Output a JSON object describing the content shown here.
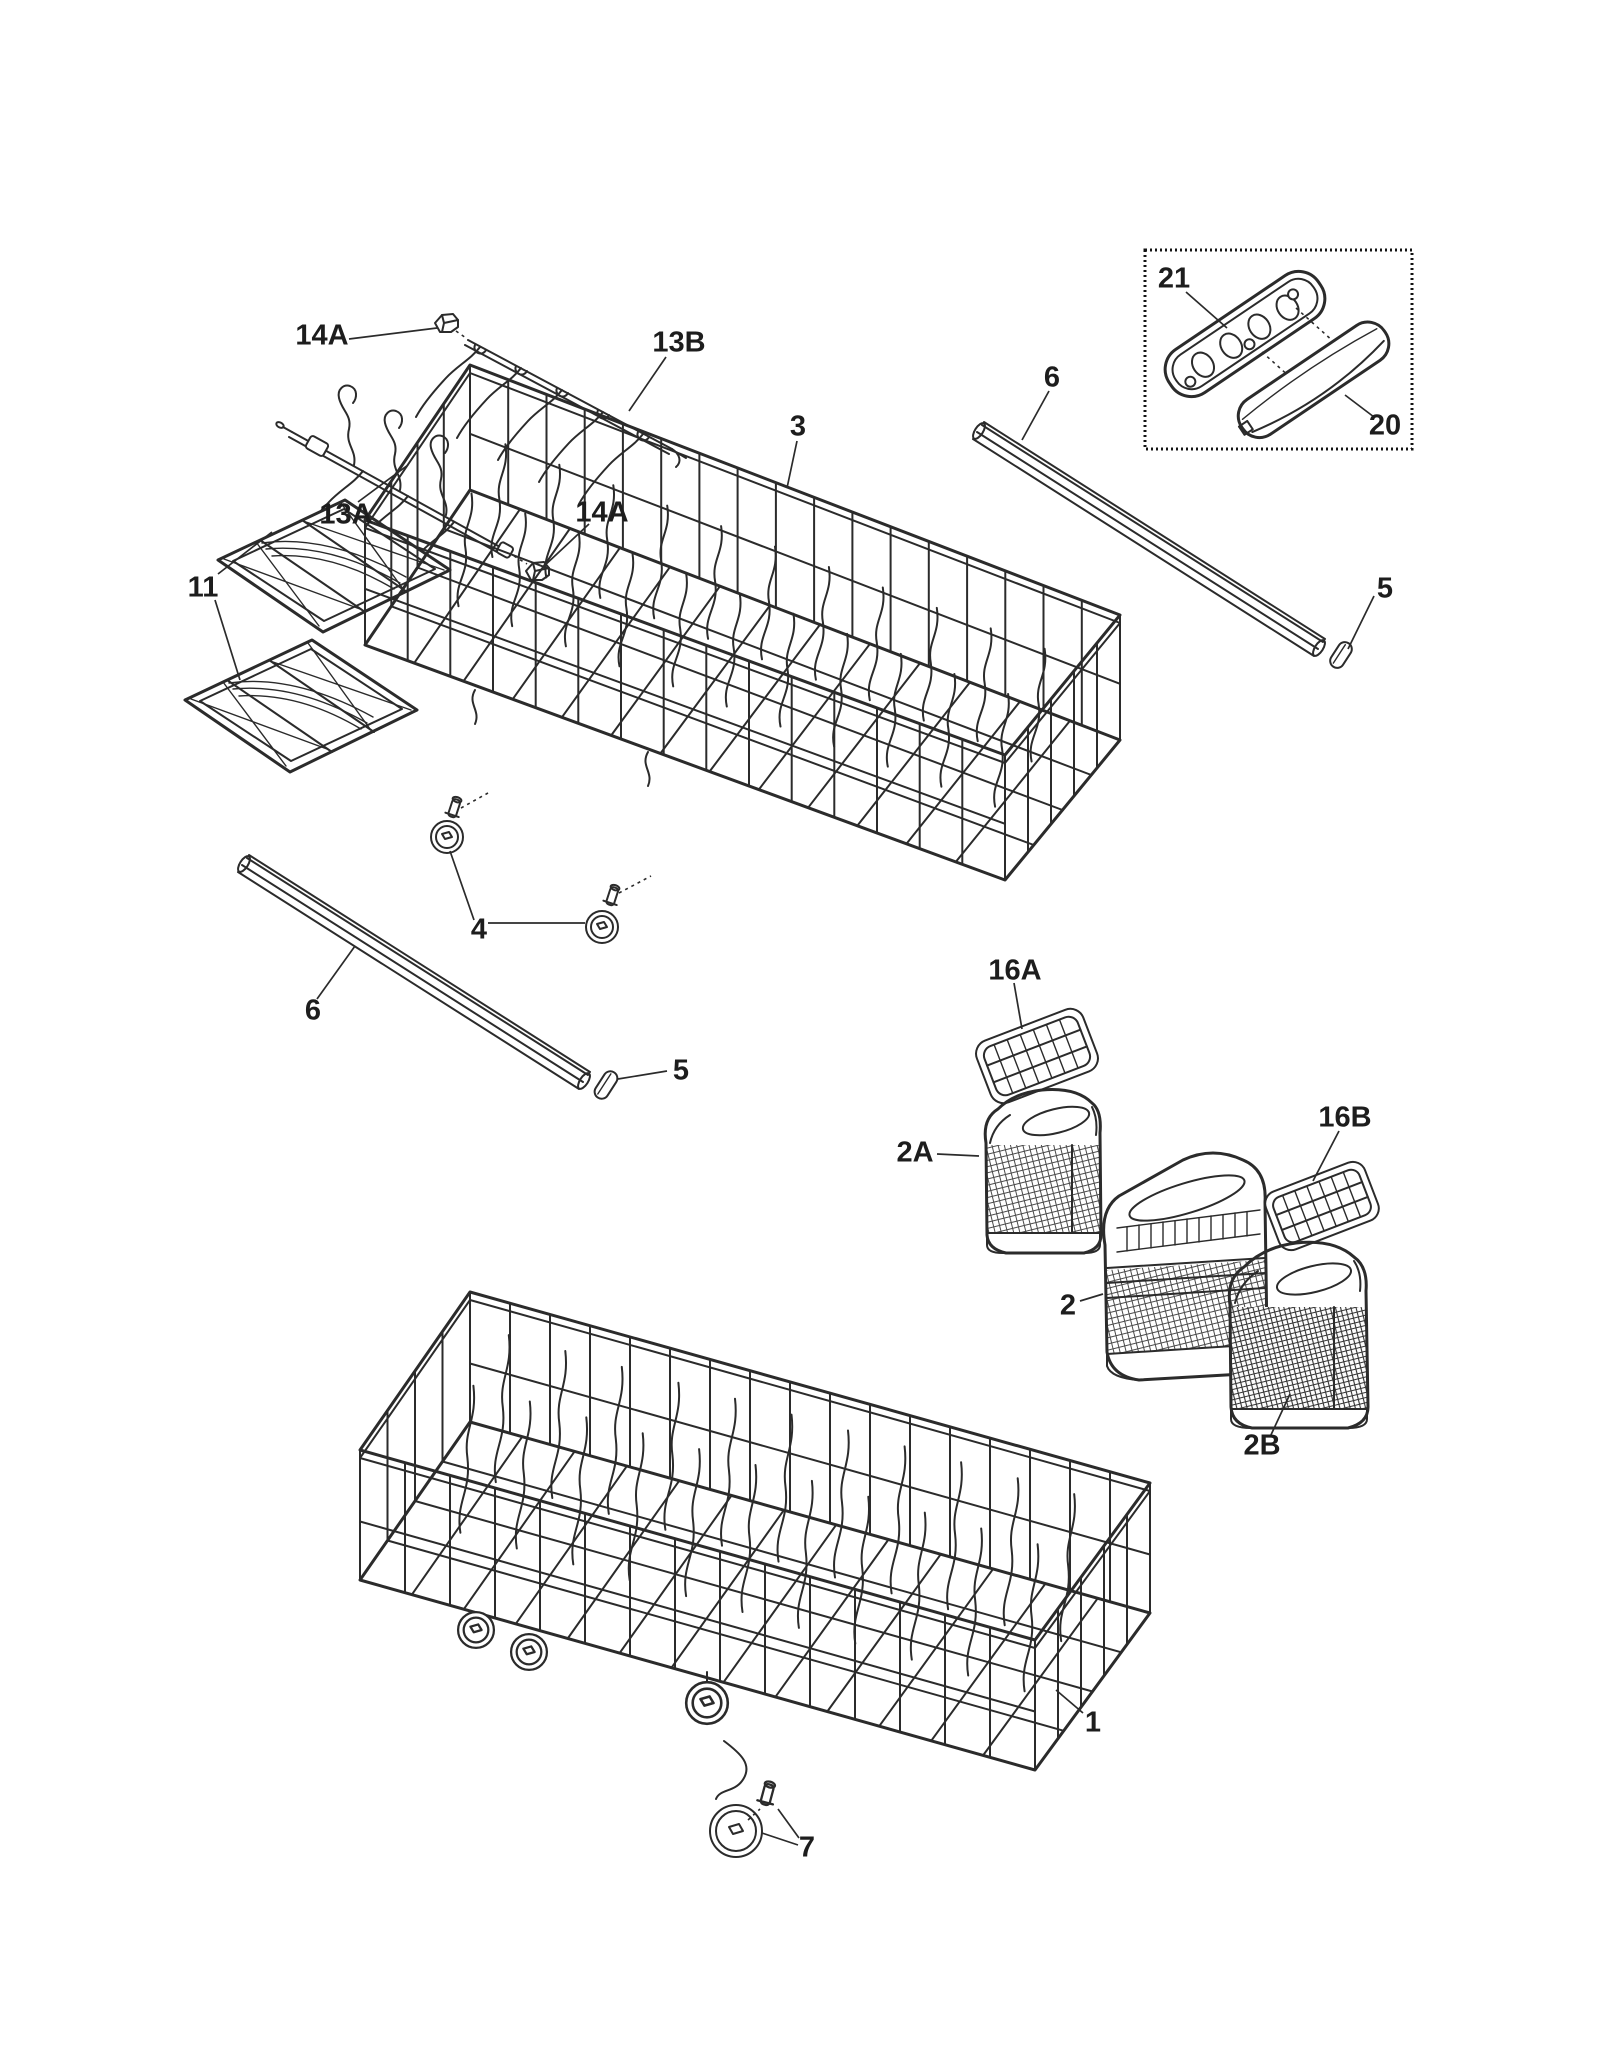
{
  "figure": {
    "type": "exploded-parts-diagram",
    "subject": "Dishwasher dishrack assembly exploded view",
    "background_color": "#ffffff",
    "line_color": "#2b2b2b",
    "label_color": "#1d1d1d"
  },
  "callouts": [
    {
      "label": "14A"
    },
    {
      "label": "13B"
    },
    {
      "label": "13A"
    },
    {
      "label": "14A"
    },
    {
      "label": "11"
    },
    {
      "label": "3"
    },
    {
      "label": "6"
    },
    {
      "label": "21"
    },
    {
      "label": "20"
    },
    {
      "label": "5"
    },
    {
      "label": "4"
    },
    {
      "label": "6"
    },
    {
      "label": "5"
    },
    {
      "label": "16A"
    },
    {
      "label": "2A"
    },
    {
      "label": "16B"
    },
    {
      "label": "2"
    },
    {
      "label": "2B"
    },
    {
      "label": "1"
    },
    {
      "label": "7"
    }
  ],
  "visible_part_numbers": [
    "1",
    "2",
    "2A",
    "2B",
    "3",
    "4",
    "5",
    "6",
    "7",
    "11",
    "13A",
    "13B",
    "14A",
    "16A",
    "16B",
    "20",
    "21"
  ]
}
